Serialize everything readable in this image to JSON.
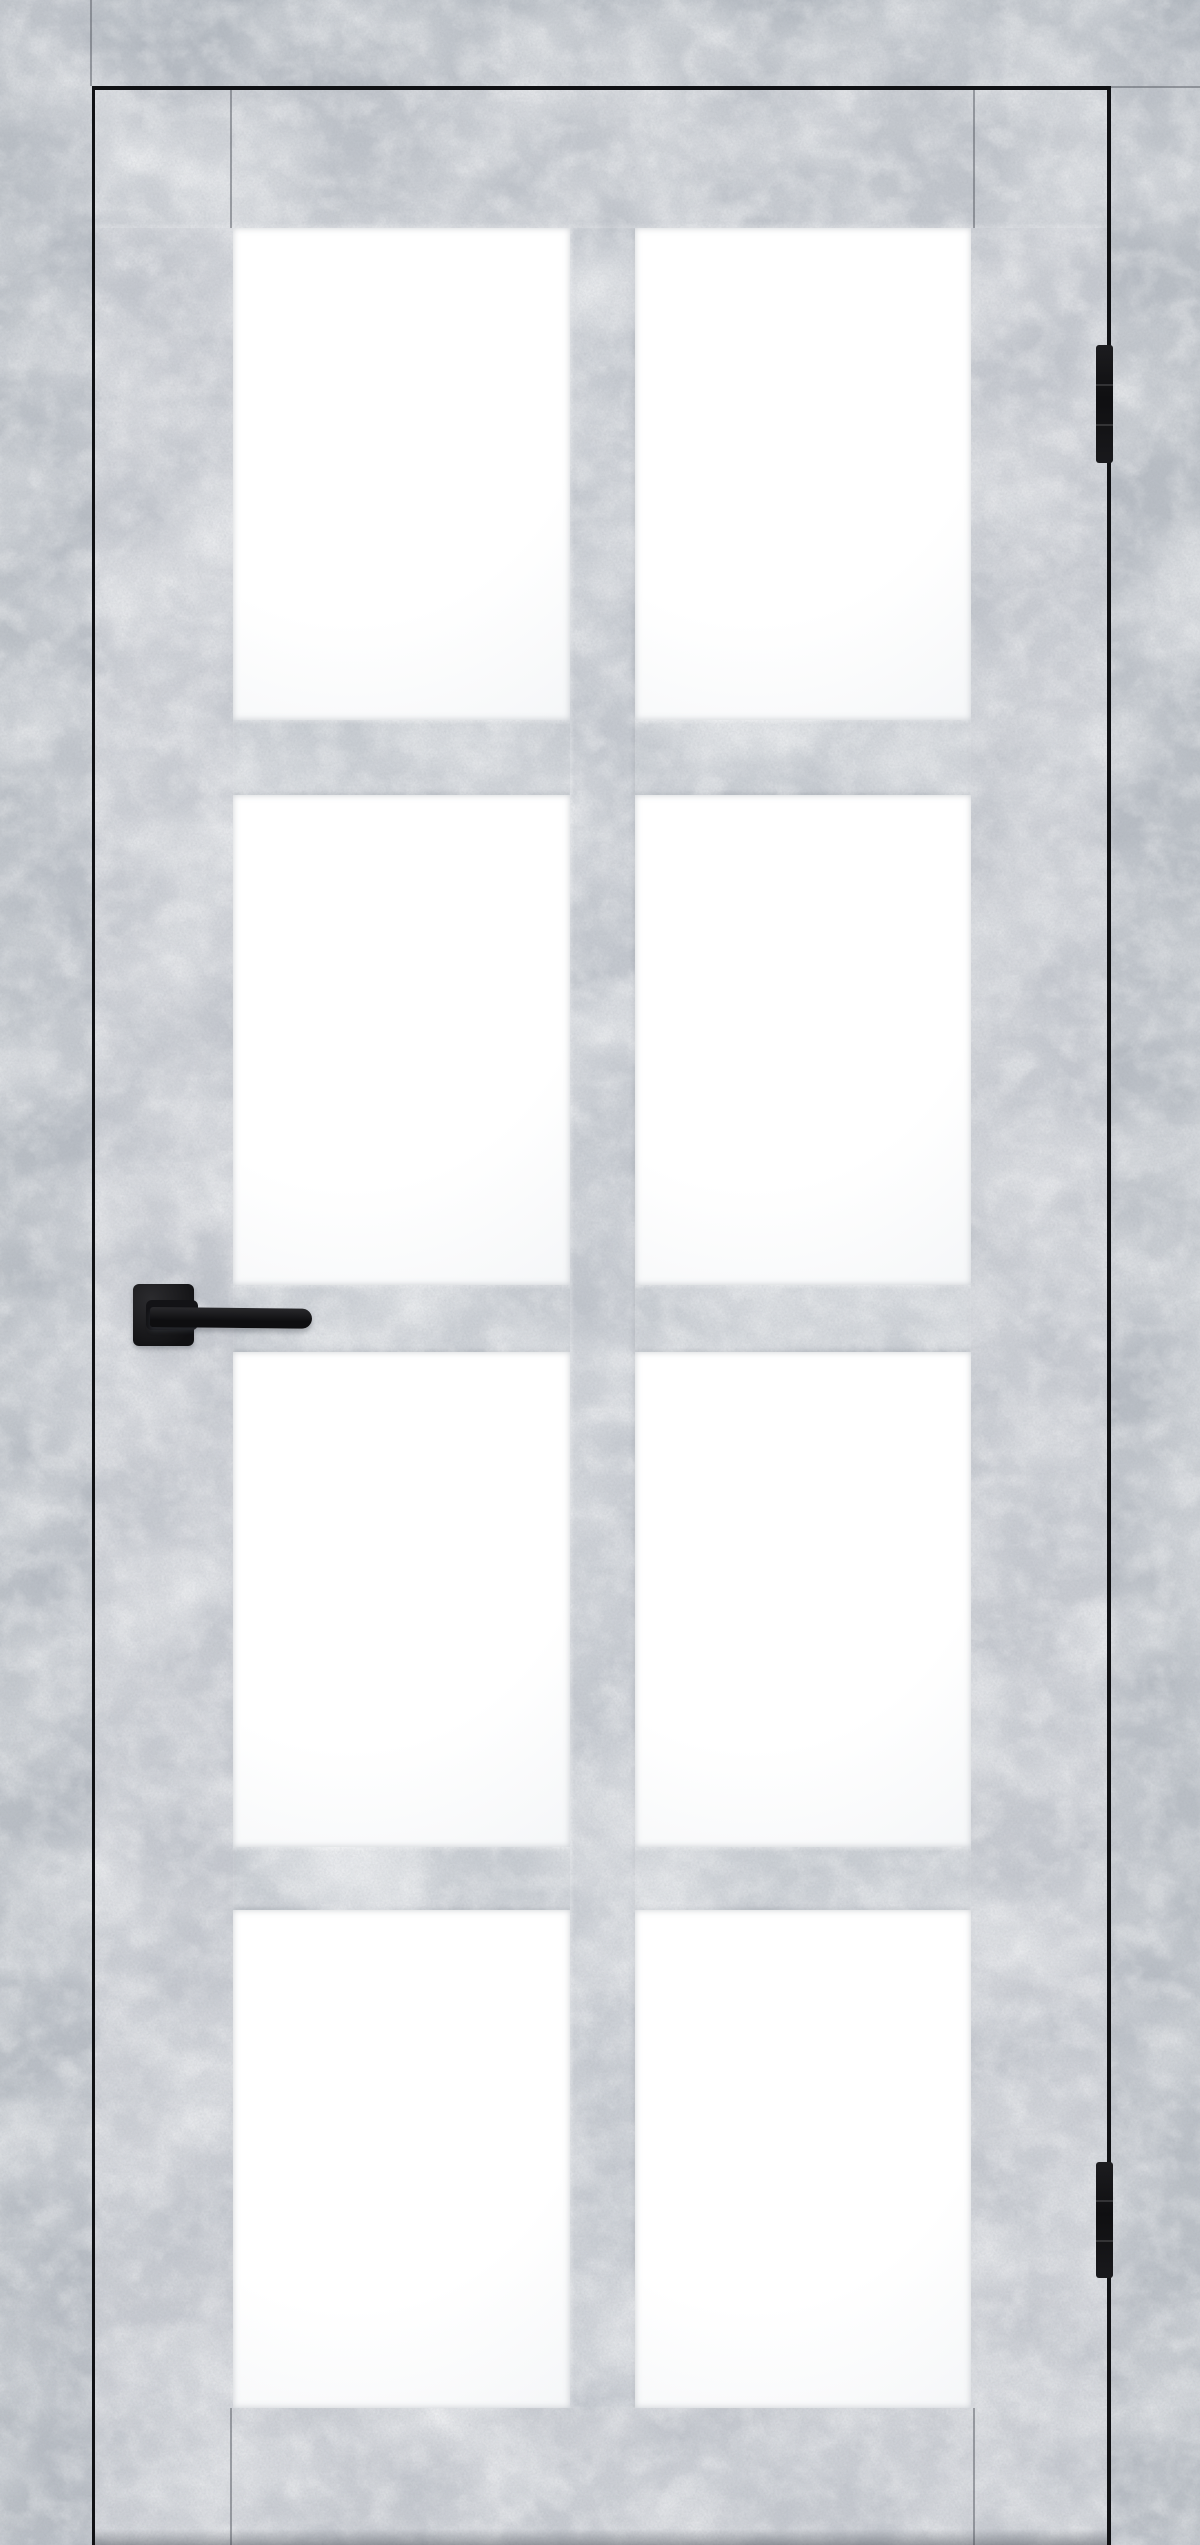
{
  "subject": {
    "type": "product photo of a closed interior door, straight front view",
    "finish": "light gray concrete-look (urban stone) laminate on door and frame",
    "glazing": "8 frosted white glass panes arranged in a 2-column by 4-row grid",
    "hardware": [
      "black square-rosette lever handle on the left stile at mid height",
      "two black barrel hinges on the right edge (upper and lower)"
    ],
    "text_visible": "none"
  },
  "colors": {
    "casing": "#b9bec5",
    "casing_top": "#b4bac1",
    "leaf": "#cacdd3",
    "top_rail": "#c5c9cf",
    "rail": "#ced2d7",
    "muntin": "#c9cdd3",
    "glass": "#ffffff",
    "glass_shadow": "rgba(146,152,162,0.45)",
    "gap": "#101114",
    "seam": "rgba(85,90,98,0.5)",
    "hardware": "#141416"
  },
  "layout": {
    "canvas": {
      "w": 1200,
      "h": 2545
    },
    "casing_top": {
      "x": 0,
      "y": 0,
      "w": 1200,
      "h": 86
    },
    "casing_left": {
      "x": 0,
      "y": 0,
      "w": 92,
      "h": 2545
    },
    "casing_right": {
      "x": 1111,
      "y": 86,
      "w": 89,
      "h": 2459
    },
    "gap_top": {
      "x": 92,
      "y": 86,
      "w": 1019,
      "h": 4
    },
    "gap_left": {
      "x": 92,
      "y": 90,
      "w": 3,
      "h": 2455
    },
    "gap_right": {
      "x": 1107,
      "y": 90,
      "w": 4,
      "h": 2455
    },
    "leaf": {
      "x": 95,
      "y": 90,
      "w": 1012,
      "h": 2455
    },
    "top_rail": {
      "x": 95,
      "y": 90,
      "w": 1012,
      "h": 138
    },
    "muntin": {
      "x": 570,
      "y": 228,
      "w": 65,
      "h": 2180
    },
    "cross_rails": [
      {
        "x": 233,
        "y": 720,
        "w": 738,
        "h": 75
      },
      {
        "x": 233,
        "y": 1285,
        "w": 738,
        "h": 67
      },
      {
        "x": 233,
        "y": 1847,
        "w": 738,
        "h": 63
      }
    ],
    "glass_cols": [
      {
        "x": 233,
        "w": 337
      },
      {
        "x": 635,
        "w": 336
      }
    ],
    "glass_rows": [
      {
        "y": 228,
        "h": 492
      },
      {
        "y": 795,
        "h": 490
      },
      {
        "y": 1352,
        "h": 495
      },
      {
        "y": 1910,
        "h": 498
      }
    ],
    "seams": [
      {
        "x": 90,
        "y": 0,
        "w": 2,
        "h": 86
      },
      {
        "x": 1111,
        "y": 86,
        "w": 89,
        "h": 2
      },
      {
        "x": 230,
        "y": 90,
        "w": 2,
        "h": 138
      },
      {
        "x": 973,
        "y": 90,
        "w": 2,
        "h": 138
      },
      {
        "x": 230,
        "y": 2408,
        "w": 2,
        "h": 137
      },
      {
        "x": 973,
        "y": 2408,
        "w": 2,
        "h": 137
      }
    ],
    "handle": {
      "rosette": {
        "x": 133,
        "y": 1284,
        "w": 61,
        "h": 62
      },
      "neck": {
        "x": 146,
        "y": 1300,
        "w": 52,
        "h": 30
      },
      "lever": {
        "x": 150,
        "y": 1307,
        "w": 162,
        "h": 20
      }
    },
    "hinges": [
      {
        "x": 1096,
        "y": 345,
        "w": 17,
        "h": 118
      },
      {
        "x": 1096,
        "y": 2162,
        "w": 17,
        "h": 116
      }
    ],
    "floor_shadow": {
      "x": 95,
      "y": 2529,
      "w": 1012,
      "h": 16
    }
  }
}
